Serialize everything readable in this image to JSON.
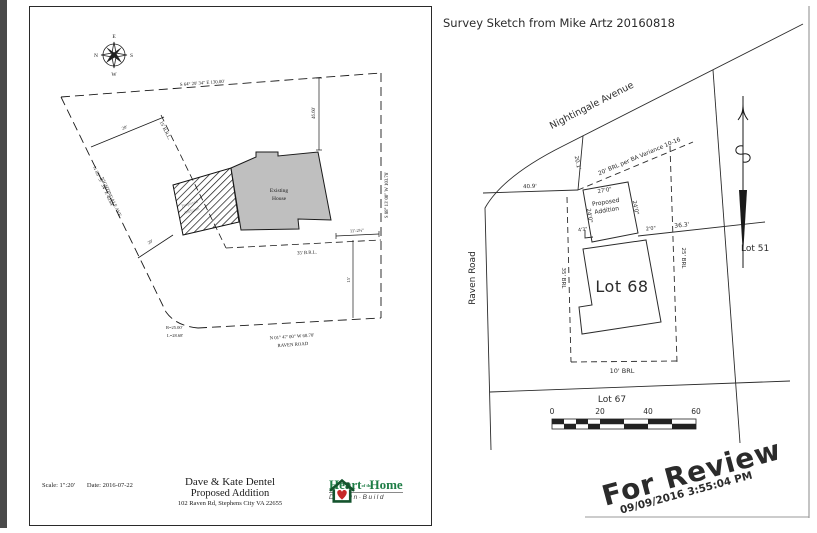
{
  "page": {
    "bg": "#ffffff",
    "edge_color": "#4a4a4a"
  },
  "left": {
    "compass": {
      "n": "N",
      "e": "E",
      "s": "S",
      "w": "W"
    },
    "labels": {
      "north_bearing": "S 64° 29' 34\" E  130.00'",
      "east_bearing": "S 88° 13' 00\" W  103.78'",
      "west_bearing": "N 85° 57' 34\" E  40.64'",
      "west_street": "NIGHTINGALE AVE.",
      "south_bearing": "N 01° 47' 00\" W  68.70'",
      "south_street": "RAVEN ROAD",
      "curve_r": "R=25.00'",
      "curve_l": "L=28.68'",
      "front_brl": "15' B.R.L.",
      "rear_brl": "35' B.R.L.",
      "offset_a": "20'",
      "offset_b": "20'",
      "dim_house": "46.60'",
      "dim_side": "11'-2½\"",
      "dim_rear": "15'",
      "house_1": "Existing",
      "house_2": "House",
      "addition_1": "Proposed",
      "addition_2": "Addition"
    },
    "title_block": {
      "scale": "Scale:  1\":20'",
      "date": "Date:  2016-07-22",
      "client": "Dave & Kate Dentel",
      "project": "Proposed Addition",
      "address": "102 Raven Rd, Stephens City VA 22655",
      "logo": {
        "word_1": "Heart",
        "word_mid": "of the",
        "word_2": "Home",
        "tagline": "Design·Build"
      }
    }
  },
  "right": {
    "title": "Survey Sketch from Mike Artz 20160818",
    "streets": {
      "nightingale": "Nightingale Avenue",
      "raven": "Raven Road"
    },
    "lots": {
      "lot68": "Lot 68",
      "lot67": "Lot 67",
      "lot51": "Lot 51"
    },
    "labels": {
      "d_201": "20.1'",
      "d_409": "40.9'",
      "brl_variance": "20' BRL per BA Variance 10-16",
      "d_270": "27'0\"",
      "d_240_l": "24'0\"",
      "d_240_r": "24'0\"",
      "d_43": "4'3\"",
      "d_20": "2'0\"",
      "d_363": "36.3'",
      "brl_25": "25' BRL",
      "brl_35": "35' BRL",
      "brl_10": "10' BRL",
      "addition_1": "Proposed",
      "addition_2": "Addition"
    },
    "scale_bar": {
      "t0": "0",
      "t1": "20",
      "t2": "40",
      "t3": "60"
    },
    "watermark": {
      "text": "For Review",
      "timestamp": "09/09/2016  3:55:04 PM",
      "color": "#8cc63f",
      "timestamp_color": "#2e2e2e"
    }
  }
}
